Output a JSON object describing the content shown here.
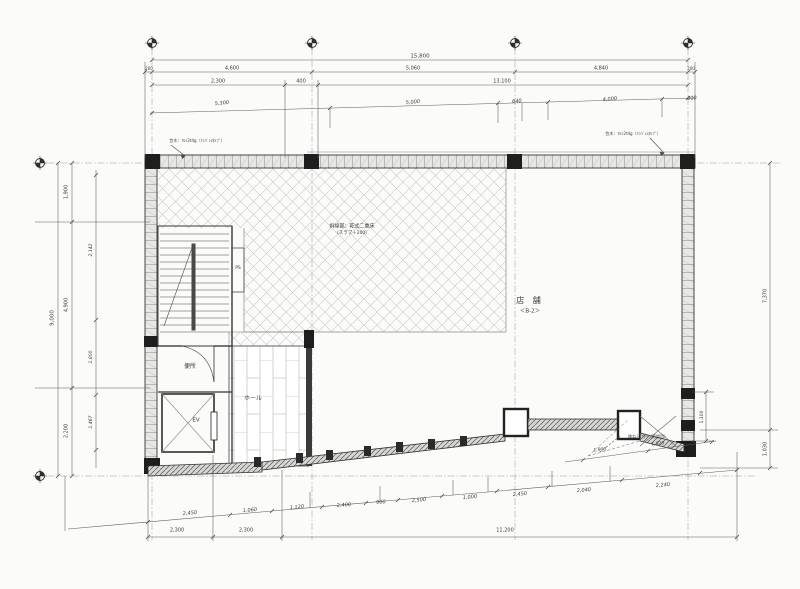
{
  "drawing": {
    "rooms": {
      "shop": "店 舗",
      "shop_code": "＜B-2＞",
      "hall": "ホール",
      "toilet": "便所",
      "elevator": "EV",
      "pipe_shaft": "PS"
    },
    "notes": {
      "hatch_line1": "斜線部：乾式二重床",
      "hatch_line2": "（スラブ＋200）",
      "parapet_left": "笠木：ｱﾙﾐ2t4g（ﾘﾝﾊﾞﾚｽﾀｲﾌﾟ）",
      "parapet_right": "笠木：ｱﾙﾐ2t4g（ﾘﾝﾊﾞﾚｽﾀｲﾌﾟ）",
      "lift_hatch": "跳ね上げ戸（荷揚用）"
    },
    "line_color": "#3f3f3f",
    "hatch_color": "#c9c9c9"
  },
  "dims": {
    "top_total": "15,800",
    "top_seg": [
      "200",
      "4,600",
      "5,060",
      "4,840",
      "200"
    ],
    "top_sub": [
      "2,300",
      "400",
      "13,100"
    ],
    "top_int": [
      "5,300",
      "5,000",
      "640",
      "4,000",
      "600"
    ],
    "left_total": "9,000",
    "left_seg": [
      "1,900",
      "4,900",
      "2,200"
    ],
    "left_int": [
      "2,142",
      "1,800",
      "1,467"
    ],
    "right_total": "7,370",
    "right_low": "1,030",
    "right_notch": "1,100",
    "bot_int": [
      "2,450",
      "1,060",
      "1,120",
      "2,400",
      "900",
      "2,500",
      "1,000",
      "2,450",
      "2,040",
      "2,240"
    ],
    "bot_seg": [
      "2,300",
      "2,300",
      "11,200"
    ],
    "detail": [
      "1,900",
      "1,820"
    ]
  }
}
